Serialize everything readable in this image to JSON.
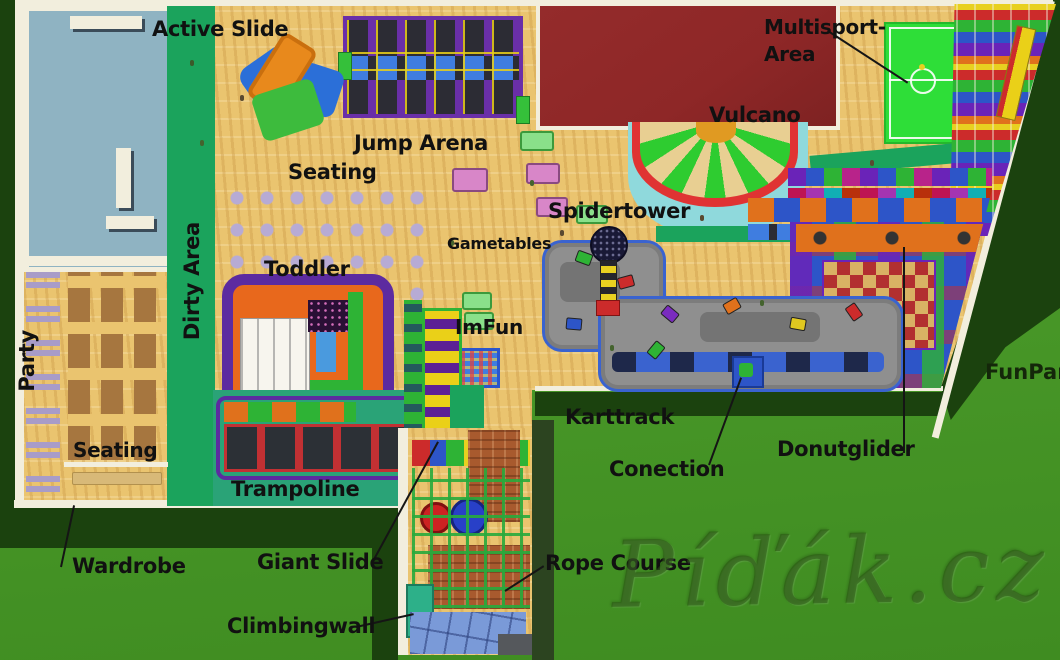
{
  "labels": {
    "active_slide": "Active Slide",
    "jump_arena": "Jump Arena",
    "seating_center": "Seating",
    "dirty_area": "Dirty Area",
    "toddler": "Toddler",
    "party": "Party",
    "seating_left": "Seating",
    "trampoline": "Trampoline",
    "wardrobe": "Wardrobe",
    "giant_slide": "Giant Slide",
    "climbingwall": "Climbingwall",
    "imfun": "ImFun",
    "gametables": "Gametables",
    "spidertower": "Spidertower",
    "vulcano": "Vulcano",
    "multisport_line1": "Multisport-",
    "multisport_line2": "Area",
    "karttrack": "Karttrack",
    "conection": "Conection",
    "donutglider": "Donutglider",
    "rope_course": "Rope Course",
    "funpark": "FunPark",
    "watermark": "Píďák.cz"
  },
  "colors": {
    "grass": "#4a9b28",
    "grass_low": "#3f8c21",
    "grass_dark": "#1b420e",
    "wood": "#eac46f",
    "wall": "#f2eedd",
    "entrance_teal": "#8fb3c2",
    "roof_red": "#8e2727",
    "walkway": "#1ba35c",
    "teal_floor": "#2aa377",
    "field_green": "#2ede38",
    "track_gray": "#8f8f8f",
    "track_blue": "#3a63cf",
    "arena_purple": "#6a2fa8",
    "mat": "#2c2c34",
    "pad_blue": "#3f7de0",
    "toddler_orange": "#e8681c",
    "toddler_purple": "#5c2ba0",
    "slide_yellow": "#ead018",
    "slide_purple": "#5c2095",
    "brick": "#a85a2e",
    "tile_blue": "#7a9ad8",
    "apron_cyan": "#8fd9dc",
    "rim_red": "#e03333",
    "wedge_green": "#2ecc30",
    "wedge_tan": "#e8cf92",
    "center_orange": "#e09a22",
    "chair": "#b7abd4",
    "table_brown": "#a6763f",
    "bench_purple": "#a89cc8",
    "checker_red": "#b23030",
    "checker_tan": "#d9b264",
    "block_blue": "#2d55c8",
    "block_purple": "#6a23b8",
    "block_green": "#2eb335",
    "block_red": "#cc2b2b",
    "block_orange": "#e0711c",
    "label": "#111111"
  }
}
